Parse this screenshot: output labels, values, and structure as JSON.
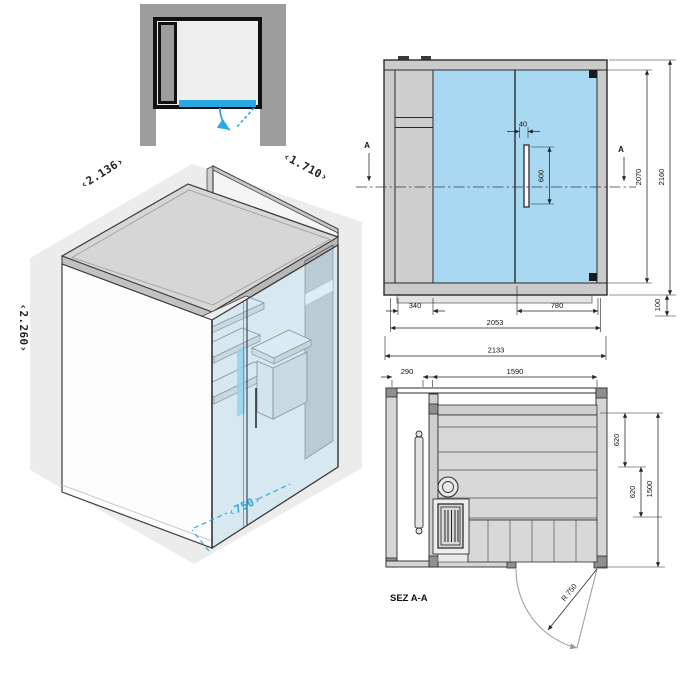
{
  "colors": {
    "glass": "#a9d9f2",
    "glass_iso": "#c3e4f5",
    "accent": "#2aa9e1",
    "panel": "#cbcbcb",
    "panel_dark": "#9d9d9d",
    "line": "#2b2b2b",
    "backdrop": "#ececec",
    "bench": "#d8d8d8"
  },
  "isometric": {
    "width_label": "‹2.136›",
    "depth_label": "‹1.710›",
    "height_label": "‹2.260›",
    "door_label": "‹750›"
  },
  "front_view": {
    "section_marker_left": "A",
    "section_marker_right": "A",
    "dims": {
      "handle_offset": "40",
      "handle_length": "600",
      "glass_height": "2070",
      "overall_height": "2160",
      "left_panel_width": "340",
      "door_width": "780",
      "body_width": "2053",
      "overall_width": "2133",
      "base_height": "100"
    }
  },
  "section_view": {
    "title": "SEZ A-A",
    "dims": {
      "tech_width": "290",
      "room_width": "1590",
      "bench_depth_upper": "620",
      "bench_depth_lower": "620",
      "room_depth": "1500",
      "door_radius": "R 750"
    }
  }
}
